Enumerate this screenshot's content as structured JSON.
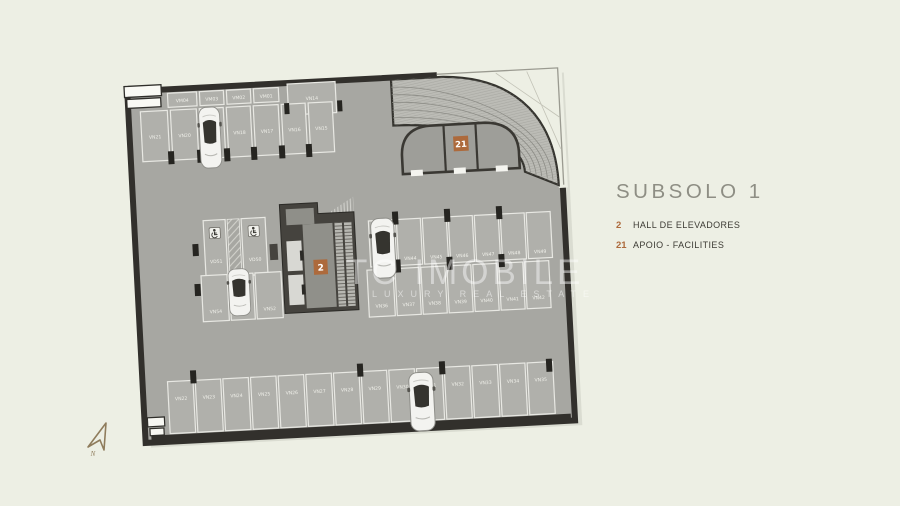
{
  "page": {
    "background_color": "#edefe4"
  },
  "legend": {
    "title": "SUBSOLO 1",
    "items": [
      {
        "number": "2",
        "label": "HALL DE ELEVADORES"
      },
      {
        "number": "21",
        "label": "APOIO - FACILITIES"
      }
    ]
  },
  "watermark": {
    "brand": "TC IMOBILE",
    "tagline": "LUXURY REAL ESTATE"
  },
  "north_arrow": {
    "label": "N"
  },
  "colors": {
    "accent_orange": "#ad6a3c",
    "floor_gray": "#a7a7a2",
    "wall_dark": "#32302c",
    "background": "#edefe4",
    "stall_line": "#e8e8e3",
    "title_gray": "#8e8e84",
    "text_dark": "#3d3b34"
  },
  "plan": {
    "markers": {
      "hall_number": "2",
      "facilities_number": "21"
    },
    "stalls": {
      "moto_row": [
        "VM04",
        "VM03",
        "VM02",
        "VM01"
      ],
      "wide_stall": "VN14",
      "top_row": [
        "VN21",
        "VN20",
        "VN19",
        "VN18",
        "VN17",
        "VN16",
        "VN15"
      ],
      "accessible": [
        "VD51",
        "VD50"
      ],
      "mid_left": [
        "VN54",
        "VN53",
        "VN52"
      ],
      "mid_upper": [
        "VN43",
        "VN44",
        "VN45",
        "VN46",
        "VN47",
        "VN48",
        "VN49"
      ],
      "mid_lower": [
        "VN36",
        "VN37",
        "VN38",
        "VN39",
        "VN40",
        "VN41",
        "VN42"
      ],
      "bottom_row": [
        "VN22",
        "VN23",
        "VN24",
        "VN25",
        "VN26",
        "VN27",
        "VN28",
        "VN29",
        "VN30",
        "VN31",
        "VN32",
        "VN33",
        "VN34",
        "VN35"
      ]
    }
  }
}
